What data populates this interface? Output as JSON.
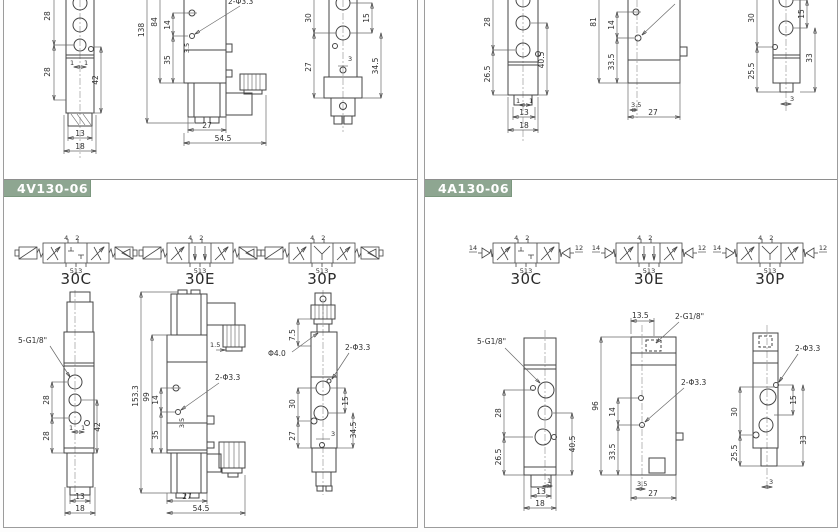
{
  "left_panel": {
    "code": "4V130-06",
    "symbols": {
      "variants": [
        "30C",
        "30E",
        "30P"
      ],
      "ports_top": "4 2",
      "ports_bottom": "513"
    },
    "top_front": {
      "h1": "28",
      "h2": "28",
      "r": "42",
      "s1": "1",
      "s2": "1",
      "w1": "13",
      "w2": "18"
    },
    "top_side": {
      "total": "138",
      "body": "84",
      "p1": "14",
      "p2": "35",
      "step": "3.5",
      "hole": "2-Φ3.3",
      "w1": "27",
      "w2": "54.5"
    },
    "top_back": {
      "h1": "30",
      "h2": "27",
      "r1": "15",
      "r2": "34.5",
      "s": "3"
    },
    "bot_front": {
      "port": "5-G1/8\"",
      "h1": "28",
      "h2": "28",
      "r": "42",
      "s1": "1",
      "s2": "1",
      "w1": "13",
      "w2": "18"
    },
    "bot_side": {
      "total": "153.3",
      "body": "99",
      "p1": "14",
      "p2": "35",
      "step": "3.5",
      "gap": "1.5",
      "hole": "2-Φ3.3",
      "w1": "27",
      "w2": "54.5"
    },
    "bot_back": {
      "t": "7.5",
      "orifice": "Φ4.0",
      "hole": "2-Φ3.3",
      "h1": "30",
      "h2": "27",
      "r1": "15",
      "r2": "34.5",
      "s": "3"
    }
  },
  "right_panel": {
    "code": "4A130-06",
    "symbols": {
      "variants": [
        "30C",
        "30E",
        "30P"
      ],
      "ports_top": "4 2",
      "ports_bottom": "513",
      "pilot_left": "14",
      "pilot_right": "12"
    },
    "top_front": {
      "h1": "28",
      "h2": "26.5",
      "r": "40.5",
      "s1": "1",
      "s2": "1",
      "w1": "13",
      "w2": "18"
    },
    "top_side": {
      "total": "81",
      "p1": "14",
      "p2": "33.5",
      "step": "3.5",
      "w1": "27"
    },
    "top_back": {
      "h1": "30",
      "h2": "25.5",
      "r1": "15",
      "r2": "33",
      "s": "3"
    },
    "bot_front": {
      "port": "5-G1/8\"",
      "h1": "28",
      "h2": "26.5",
      "r": "40.5",
      "s": "1",
      "w1": "13",
      "w2": "18"
    },
    "bot_side": {
      "top_w": "13.5",
      "port": "2-G1/8\"",
      "total": "96",
      "p1": "14",
      "p2": "33.5",
      "hole": "2-Φ3.3",
      "step": "3.5",
      "w1": "27"
    },
    "bot_back": {
      "hole": "2-Φ3.3",
      "h1": "30",
      "h2": "25.5",
      "r1": "15",
      "r2": "33",
      "s": "3"
    }
  }
}
